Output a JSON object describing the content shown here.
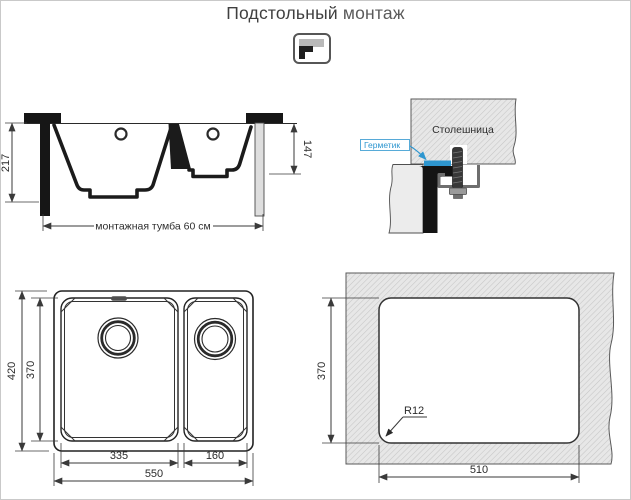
{
  "title": {
    "text_primary": "Подстольный",
    "text_secondary": "монтаж"
  },
  "icons": {
    "mount_type": "undermount-corner-icon"
  },
  "colors": {
    "accent_blue": "#2e96cf",
    "line_dark": "#1b1b1b",
    "hatch_fill": "#e7e7e7",
    "hatch_stroke": "#c6c6c6",
    "title_text": "#3f3f3f"
  },
  "side_view": {
    "depth_total_mm": "217",
    "depth_small_bowl_mm": "147",
    "cabinet_label": "монтажная тумба 60 см"
  },
  "detail_view": {
    "countertop_label": "Столешница",
    "sealant_label": "Герметик"
  },
  "top_view": {
    "outer_height_mm": "420",
    "bowl_height_mm": "370",
    "main_bowl_width_mm": "335",
    "half_bowl_width_mm": "160",
    "outer_width_mm": "550"
  },
  "cutout_view": {
    "cutout_height_mm": "370",
    "cutout_width_mm": "510",
    "corner_radius_label": "R12"
  }
}
